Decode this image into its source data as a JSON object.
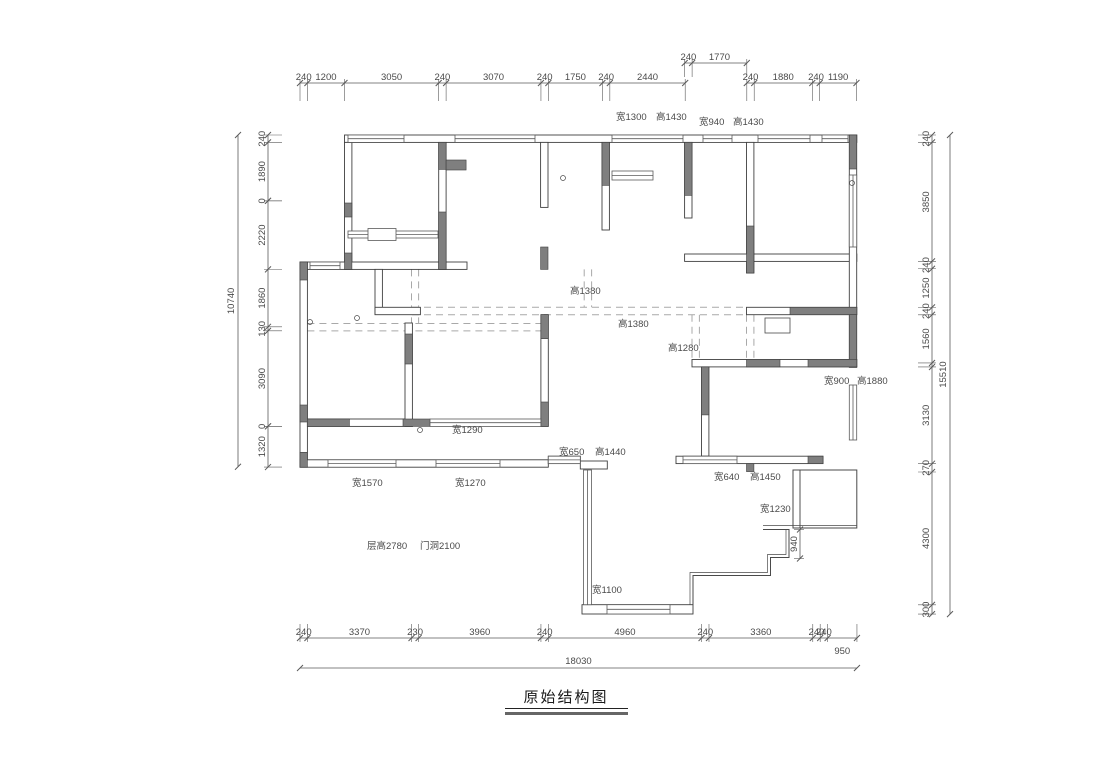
{
  "title": {
    "text": "原始结构图"
  },
  "drawing": {
    "scale_px_per_mm": 0.03089,
    "colors": {
      "wall_line": "#3f3f3f",
      "concrete_fill": "#7f7f7f",
      "window_line": "#5a5a5a",
      "beam_dashed": "#a9a9a9",
      "dim_line": "#5a5a5a",
      "dim_text": "#4a4a4a",
      "annotation_text": "#4a4a4a"
    },
    "dim_chains": [
      {
        "id": "top-main",
        "orient": "h",
        "line": 83,
        "start": 300,
        "ext": 18,
        "segs": [
          {
            "mm": 240,
            "label": "240"
          },
          {
            "mm": 1200,
            "label": "1200"
          },
          {
            "mm": 3050,
            "label": "3050"
          },
          {
            "mm": 240,
            "label": "240"
          },
          {
            "mm": 3070,
            "label": "3070"
          },
          {
            "mm": 240,
            "label": "240"
          },
          {
            "mm": 1750,
            "label": "1750"
          },
          {
            "mm": 240,
            "label": "240"
          },
          {
            "mm": 2440,
            "label": "2440"
          }
        ]
      },
      {
        "id": "top-upper",
        "orient": "h",
        "line": 63,
        "start": 684.7,
        "ext": 14,
        "segs": [
          {
            "mm": 240,
            "label": "240"
          },
          {
            "mm": 1770,
            "label": "1770"
          }
        ]
      },
      {
        "id": "top-right",
        "orient": "h",
        "line": 83,
        "start": 746.8,
        "ext": 18,
        "segs": [
          {
            "mm": 240,
            "label": "240"
          },
          {
            "mm": 1880,
            "label": "1880"
          },
          {
            "mm": 240,
            "label": "240"
          },
          {
            "mm": 1190,
            "label": "1190"
          }
        ]
      },
      {
        "id": "bottom",
        "orient": "h",
        "line": 638,
        "start": 300,
        "ext": -14,
        "segs": [
          {
            "mm": 240,
            "label": "240"
          },
          {
            "mm": 3370,
            "label": "3370"
          },
          {
            "mm": 230,
            "label": "230"
          },
          {
            "mm": 3960,
            "label": "3960"
          },
          {
            "mm": 240,
            "label": "240"
          },
          {
            "mm": 4960,
            "label": "4960"
          },
          {
            "mm": 240,
            "label": "240"
          },
          {
            "mm": 3360,
            "label": "3360"
          },
          {
            "mm": 240,
            "label": "240"
          },
          {
            "mm": 240,
            "label": "240"
          },
          {
            "mm": 950,
            "label": "950",
            "dy": 19
          }
        ]
      },
      {
        "id": "left",
        "orient": "v",
        "line": 268,
        "start": 135,
        "ext": 14,
        "segs": [
          {
            "mm": 240,
            "label": "240"
          },
          {
            "mm": 1890,
            "label": "1890"
          },
          {
            "mm": 0,
            "label": "0"
          },
          {
            "mm": 2220,
            "label": "2220"
          },
          {
            "mm": 1860,
            "label": "1860"
          },
          {
            "mm": 130,
            "label": "130"
          },
          {
            "mm": 3090,
            "label": "3090"
          },
          {
            "mm": 0,
            "label": "0"
          },
          {
            "mm": 1320,
            "label": "1320"
          }
        ]
      },
      {
        "id": "right",
        "orient": "v",
        "line": 932,
        "start": 135,
        "ext": -14,
        "segs": [
          {
            "mm": 240,
            "label": "240"
          },
          {
            "mm": 3850,
            "label": "3850"
          },
          {
            "mm": 240,
            "label": "240"
          },
          {
            "mm": 1250,
            "label": "1250"
          },
          {
            "mm": 240,
            "label": "240"
          },
          {
            "mm": 1560,
            "label": "1560"
          },
          {
            "mm": 130,
            "label": ""
          },
          {
            "mm": 3130,
            "label": "3130"
          },
          {
            "mm": 270,
            "label": "270"
          },
          {
            "mm": 4300,
            "label": "4300"
          },
          {
            "mm": 300,
            "label": "300"
          }
        ]
      },
      {
        "id": "step-940",
        "orient": "v",
        "line": 800,
        "start": 529.5,
        "ext": -6,
        "segs": [
          {
            "mm": 940,
            "label": "940"
          }
        ]
      }
    ],
    "overall_dims": [
      {
        "id": "overall-bottom",
        "orient": "h",
        "line": 668,
        "start": 300,
        "mm": 18030,
        "label": "18030"
      },
      {
        "id": "overall-left",
        "orient": "v",
        "line": 238,
        "start": 135,
        "mm": 10740,
        "label": "10740"
      },
      {
        "id": "overall-right",
        "orient": "v",
        "line": 950,
        "start": 135,
        "mm": 15510,
        "label": "15510"
      }
    ],
    "annotations": [
      {
        "x": 616,
        "y": 120,
        "text": "宽1300"
      },
      {
        "x": 656,
        "y": 120,
        "text": "高1430"
      },
      {
        "x": 699,
        "y": 125,
        "text": "宽940"
      },
      {
        "x": 733,
        "y": 125,
        "text": "高1430"
      },
      {
        "x": 570,
        "y": 294,
        "text": "高1380"
      },
      {
        "x": 618,
        "y": 327,
        "text": "高1380"
      },
      {
        "x": 668,
        "y": 351,
        "text": "高1280"
      },
      {
        "x": 824,
        "y": 384,
        "text": "宽900"
      },
      {
        "x": 857,
        "y": 384,
        "text": "高1880"
      },
      {
        "x": 452,
        "y": 433,
        "text": "宽1290"
      },
      {
        "x": 559,
        "y": 455,
        "text": "宽650"
      },
      {
        "x": 595,
        "y": 455,
        "text": "高1440"
      },
      {
        "x": 352,
        "y": 486,
        "text": "宽1570"
      },
      {
        "x": 455,
        "y": 486,
        "text": "宽1270"
      },
      {
        "x": 714,
        "y": 480,
        "text": "宽640"
      },
      {
        "x": 750,
        "y": 480,
        "text": "高1450"
      },
      {
        "x": 760,
        "y": 512,
        "text": "宽1230"
      },
      {
        "x": 367,
        "y": 549,
        "text": "层高2780"
      },
      {
        "x": 420,
        "y": 549,
        "text": "门洞2100"
      },
      {
        "x": 592,
        "y": 593,
        "text": "宽1100"
      }
    ]
  }
}
